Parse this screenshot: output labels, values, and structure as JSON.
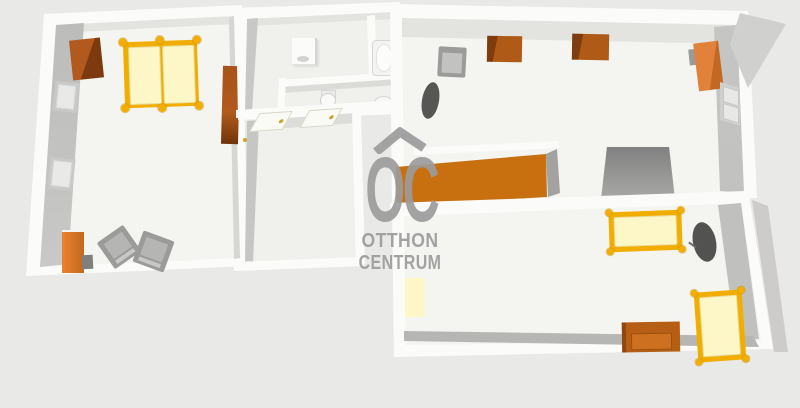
{
  "watermark": {
    "roof_icon": "house-roof-icon",
    "logo_text": "OC",
    "line1": "OTTHON",
    "line2": "CENTRUM"
  },
  "colors": {
    "bg": "#e9e9e8",
    "wall": "#fbfbf9",
    "floor": "#f4f4f1",
    "floor-mid": "#f0f0ed",
    "shade-light": "#e3e3e0",
    "shade-mid": "#c9c9c7",
    "shade-dark": "#b6b6b4",
    "gold": "#f2ae00",
    "cream": "#fdf6c6",
    "sideboard": "#c86f10",
    "brown": "#b05a18",
    "brown-dark": "#7d3a0e",
    "orange": "#e07c2a",
    "gray-furn": "#a2a2a0",
    "gray-dark": "#565654",
    "wm": "#9c9c9c",
    "handle": "#d0a028"
  },
  "rooms": [
    {
      "label": "bedroom-left",
      "furniture": [
        "wardrobe",
        "double-bed",
        "tall-cabinet",
        "window",
        "window",
        "dresser",
        "tv-stand",
        "armchair",
        "armchair",
        "door-handle"
      ]
    },
    {
      "label": "bathroom",
      "furniture": [
        "washing-machine",
        "bathtub"
      ]
    },
    {
      "label": "wc-corridor",
      "furniture": [
        "toilet",
        "wash-basin"
      ]
    },
    {
      "label": "hall",
      "furniture": [
        "open-door",
        "open-door"
      ]
    },
    {
      "label": "room-middle",
      "furniture": []
    },
    {
      "label": "living-top-right",
      "furniture": [
        "armchair",
        "oval-rug",
        "storage-box",
        "storage-box",
        "wardrobe",
        "window",
        "area-rug",
        "sideboard"
      ]
    },
    {
      "label": "bedroom-bottom-right",
      "furniture": [
        "single-bed",
        "standing-mirror",
        "floor-mat",
        "sofa-chest",
        "single-bed"
      ]
    }
  ]
}
